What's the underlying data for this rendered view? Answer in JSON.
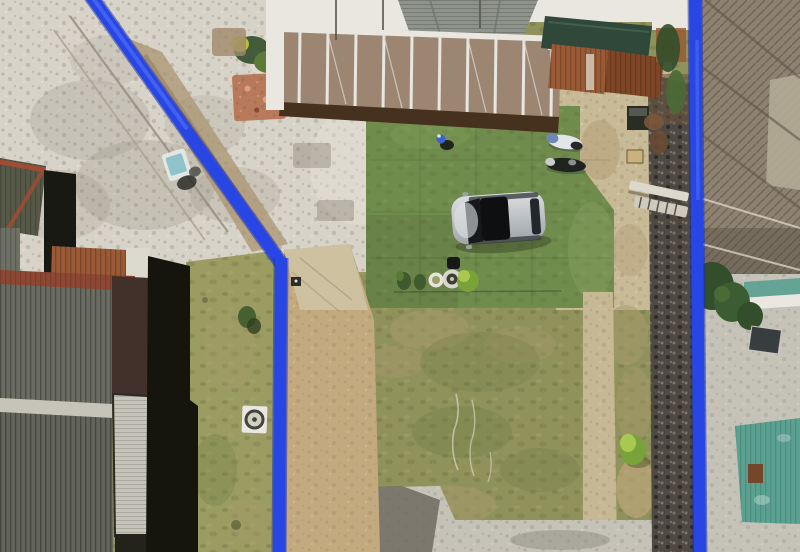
{
  "scene": {
    "type": "aerial-drone-photo",
    "description": "Top-down aerial photograph of a residential land plot outlined with thick blue boundary lines; paved plaza upper-left, carport house top-center, bright turf with parked car, patchy rear lawn, neighboring roofs left and right"
  },
  "labels": {
    "boundary_diagonal": "blue boundary line (diagonal, upper-left)",
    "boundary_left": "blue boundary line (left, vertical)",
    "boundary_right": "blue boundary line (right, vertical)",
    "plaza": "paved cobblestone plaza",
    "carport": "carport with brown roof panels and white frame",
    "gable_roof": "gray shingled gable roof",
    "awning": "dark green awning",
    "rust_roof": "rusty corrugated roof",
    "turf": "bright green artificial turf",
    "lawn": "patchy rear lawn",
    "grass_strip": "grass strip outside left boundary",
    "courtyard": "sandy side courtyard",
    "stone_wall": "dark stone boundary wall",
    "car": "silver car parked on turf",
    "person": "person crouching on turf",
    "scooter_white": "white motorbike",
    "scooter_dark": "dark motorbike",
    "planters": "row of potted plants and bushes",
    "ladder": "ladder and plank near wall",
    "dirt_path": "tan dirt path",
    "ramp": "concrete driveway ramp",
    "neighbor_left": "neighboring corrugated roofs (left)",
    "neighbor_right": "weathered neighboring roof (right)",
    "teal_roof": "teal corrugated roof",
    "trees_right": "trees along right boundary",
    "well": "white slab with round well cover",
    "steps": "stepped walkway under boundary line"
  },
  "colors": {
    "boundary_blue": "#2746e3",
    "boundary_blue_dark": "#1b2fb0",
    "boundary_blue_light": "#4a68f2",
    "plaza": "#d7d3c8",
    "plaza_mottle": "#8f887a",
    "plaza_light": "#e6e3d9",
    "turf": "#6f8c4c",
    "turf_dark": "#3d4a28",
    "lawn": "#90925c",
    "lawn_brown": "#a89a6c",
    "lawn_dark": "#6f7a44",
    "grass_strip": "#9a9c62",
    "sand": "#c9ba97",
    "tan_path": "#c3aa7e",
    "ramp": "#cfc3a4",
    "dirt": "#ab9471",
    "concrete": "#c5c2b8",
    "concrete_dark": "#6e6b60",
    "stone_wall": "#4e4a43",
    "roof_old": "#8d8171",
    "roof_old_light": "#b3aa95",
    "roof_gray": "#6a6c62",
    "roof_gray2": "#63655b",
    "roof_maroon": "#42302a",
    "roof_red": "#8d4733",
    "ridge_red": "#9e4c33",
    "rust": "#9a5a35",
    "teal": "#5aa191",
    "awning": "#30483a",
    "panel_tan": "#9c8672",
    "fascia": "#46311f",
    "white": "#e9e7e0",
    "shingle": "#8f948b",
    "shadow_black": "#15150e",
    "skylight": "#c6c3b8",
    "car_silver": "#bcc0c4",
    "car_dark": "#16181a",
    "person_blue": "#3c63c8",
    "bush": "#79a23b",
    "bush_light": "#a8c94f",
    "tree": "#324e2a"
  }
}
